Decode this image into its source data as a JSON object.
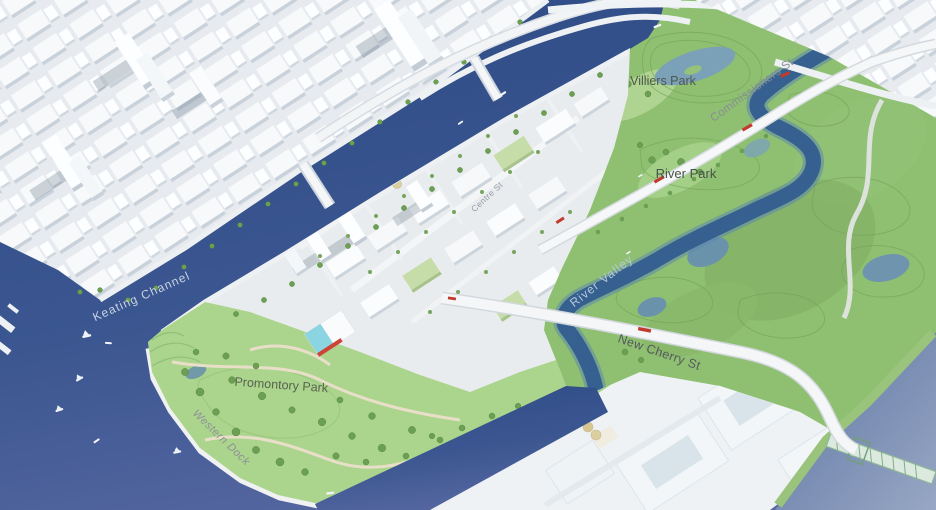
{
  "map": {
    "labels": {
      "villiers_park": {
        "text": "Villiers Park",
        "color": "#4d584b"
      },
      "river_park": {
        "text": "River Park",
        "color": "#46524a"
      },
      "promontory_park": {
        "text": "Promontory Park",
        "color": "#57634f"
      },
      "commissioners_st": {
        "text": "Commissioners St",
        "color": "#878d95"
      },
      "centre_st": {
        "text": "Centre St",
        "color": "#959ba3"
      },
      "new_cherry_st": {
        "text": "New Cherry St",
        "color": "#54595f"
      },
      "keating_channel": {
        "text": "Keating Channel",
        "color": "#c7d3e2"
      },
      "river_valley": {
        "text": "River Valley",
        "color": "#b5c8d8"
      },
      "western_dock": {
        "text": "Western Dock",
        "color": "#8d9196"
      }
    },
    "palette": {
      "harbour_water_dark": "#2f4c86",
      "harbour_water_light": "#5868a2",
      "ship_channel_water": "#97a7c4",
      "river_water": "#35608f",
      "pond_water": "#7ba1b9",
      "park_green_light": "#abd48d",
      "park_green_mid": "#8fc071",
      "park_green_dark": "#85b369",
      "contour_green": "#6f9e55",
      "tree_green": "#6ba053",
      "city_white": "#f7f9fb",
      "building_shade": "#c9d2da",
      "road_white": "#f4f6f7",
      "accent_red": "#c23a2c",
      "pool_cyan": "#8ad5e1",
      "silo_tan": "#dccf9f",
      "bridge_green": "#8fb896"
    }
  }
}
